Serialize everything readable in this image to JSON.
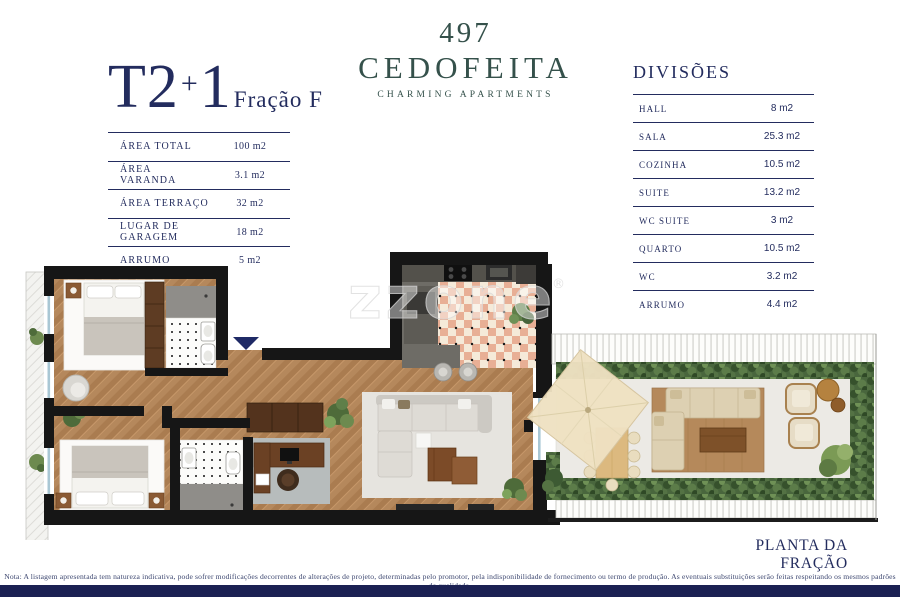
{
  "unit": {
    "type": "T2",
    "plus": "+",
    "one": "1",
    "fraction": "Fração F"
  },
  "logo": {
    "number": "497",
    "name": "CEDOFEITA",
    "tagline": "CHARMING APARTMENTS"
  },
  "area_table": {
    "rows": [
      {
        "label": "ÁREA TOTAL",
        "value": "100 m2"
      },
      {
        "label": "ÁREA VARANDA",
        "value": "3.1 m2"
      },
      {
        "label": "ÁREA TERRAÇO",
        "value": "32 m2"
      },
      {
        "label": "LUGAR DE GARAGEM",
        "value": "18 m2"
      },
      {
        "label": "ARRUMO",
        "value": "5 m2"
      }
    ]
  },
  "divisions_table": {
    "title": "DIVISÕES",
    "rows": [
      {
        "label": "HALL",
        "value": "8 m2"
      },
      {
        "label": "SALA",
        "value": "25.3 m2"
      },
      {
        "label": "COZINHA",
        "value": "10.5 m2"
      },
      {
        "label": "SUITE",
        "value": "13.2 m2"
      },
      {
        "label": "WC SUITE",
        "value": "3 m2"
      },
      {
        "label": "QUARTO",
        "value": "10.5 m2"
      },
      {
        "label": "WC",
        "value": "3.2 m2"
      },
      {
        "label": "ARRUMO",
        "value": "4.4 m2"
      }
    ]
  },
  "plan": {
    "caption": "PLANTA DA FRAÇÃO",
    "watermark": "zzone",
    "watermark_mark": "®"
  },
  "footer": {
    "note": "Nota: A listagem apresentada tem natureza indicativa, pode sofrer modificações decorrentes de alterações de projeto, determinadas pelo promotor, pela indisponibilidade de fornecimento ou termo de produção. As eventuais substituições serão feitas respeitando os mesmos padrões de qualidade."
  },
  "colors": {
    "navy_text": "#232c5e",
    "brand_green": "#35514b",
    "footer_bar": "#1b2153",
    "wall_black": "#161616",
    "wood_floor": "#b5885c",
    "kitchen_tile": "#e8af95",
    "hedge_green": "#49663d",
    "parasol_cream": "#eee1c2"
  }
}
